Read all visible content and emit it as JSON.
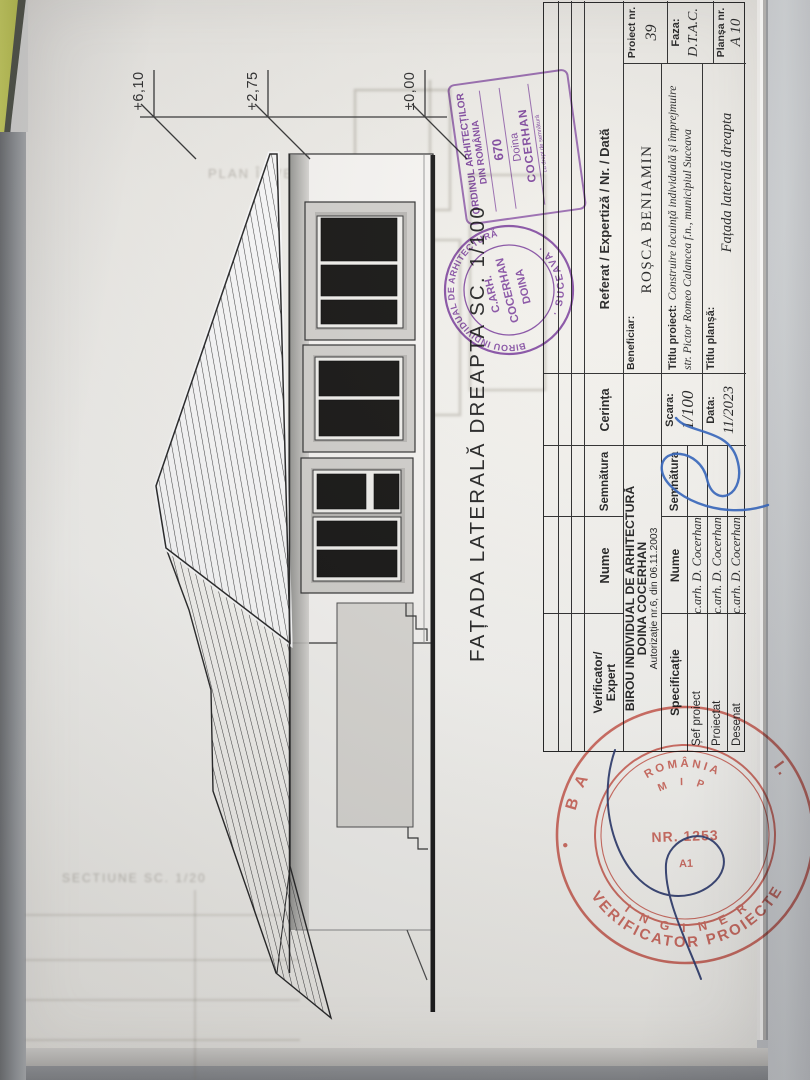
{
  "drawing": {
    "title": "FAȚADA LATERALĂ DREAPTA SC. 1/100",
    "levels": [
      {
        "label": "+6,10"
      },
      {
        "label": "+2,75"
      },
      {
        "label": "±0,00"
      }
    ]
  },
  "ghost": {
    "plan_text": "PLAN ÎNVELITOARE SC",
    "sectiune_text": "SECTIUNE SC. 1/20"
  },
  "cartouche": {
    "header": {
      "verificator": "Verificator/",
      "expert": "Expert",
      "nume": "Nume",
      "semnatura": "Semnătura",
      "cerinta": "Cerința",
      "referat": "Referat / Expertiză / Nr. / Dată"
    },
    "birou": {
      "line1": "BIROU INDIVIDUAL DE ARHITECTURĂ",
      "line2": "DOINA COCERHAN",
      "line3": "Autorizație nr.6, din 06.11.2003"
    },
    "beneficiar_label": "Beneficiar:",
    "beneficiar_name": "ROȘCA BENIAMIN",
    "spec_header": {
      "specificatie": "Specificație",
      "nume": "Nume",
      "semnatura": "Semnătura"
    },
    "spec_rows": [
      {
        "role": "Șef proiect",
        "name": "c.arh. D. Cocerhan"
      },
      {
        "role": "Proiectat",
        "name": "c.arh. D. Cocerhan"
      },
      {
        "role": "Desenat",
        "name": "c.arh. D. Cocerhan"
      }
    ],
    "scara_label": "Scara:",
    "scara_value": "1/100",
    "data_label": "Data:",
    "data_value": "11/2023",
    "titlu_proiect_label": "Titlu proiect:",
    "titlu_proiect_line1": "Construire locuință individuală și împrejmuire",
    "titlu_proiect_line2": "str. Pictor Romeo Calancea f.n., municipiul Suceava",
    "titlu_plansa_label": "Titlu planșă:",
    "titlu_plansa_value": "Fațada laterală dreapta",
    "proiect_nr_label": "Proiect nr.",
    "proiect_nr_value": "39",
    "faza_label": "Faza:",
    "faza_value": "D.T.A.C.",
    "plansa_nr_label": "Planșa nr.",
    "plansa_nr_value": "A 10"
  },
  "stamps": {
    "oar": {
      "line1": "ORDINUL ARHITECȚILOR",
      "line2": "DIN ROMÂNIA",
      "number": "670",
      "name1": "Doina",
      "name2": "COCERHAN",
      "small": "cu drept de semnătură"
    },
    "birou_round": {
      "ring_top": "BIROU INDIVIDUAL DE ARHITECTURĂ",
      "ring_bottom": "·  SUCEAVA  ·",
      "center1": "C.ARH.",
      "center2": "COCERHAN",
      "center3": "DOINA"
    },
    "verificator": {
      "arc_name_left": "B A",
      "arc_name_right": "I.",
      "outer_bottom": "VERIFICATOR PROIECTE",
      "mid_bottom": "I N G I N E R",
      "inner_top": "ROMÂNIA",
      "inner_mid": "M I P",
      "inner_center": "NR. 1253",
      "inner_sub": "A1"
    }
  },
  "colors": {
    "stamp_purple": "#7d3ca6",
    "stamp_red": "#cc4a3d",
    "signature_blue": "#2f62bd",
    "signature_navy": "#2c3a6e",
    "paper": "#f6f4f0"
  }
}
